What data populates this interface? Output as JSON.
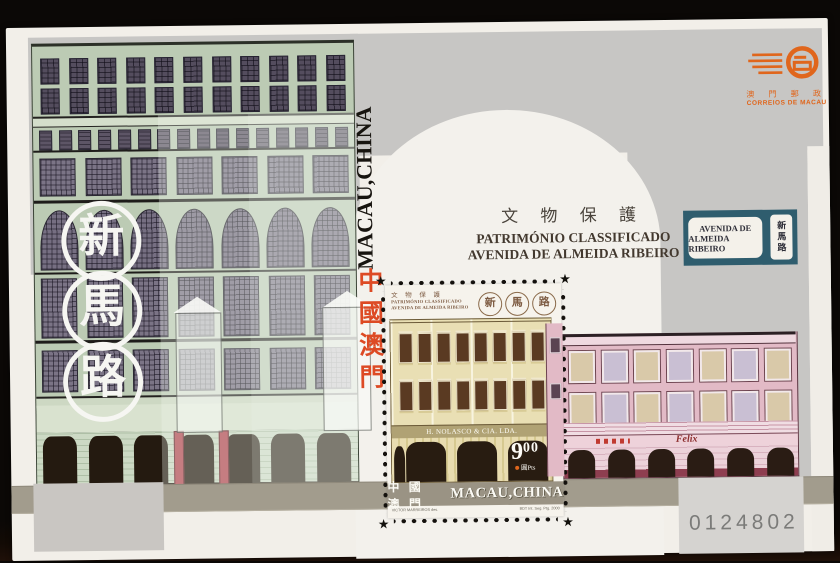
{
  "scan": {
    "serial_number": "0124802"
  },
  "sheet": {
    "street_name_chars": [
      "新",
      "馬",
      "路"
    ],
    "title_vertical_latin": "MACAU,CHINA",
    "title_vertical_cjk": "中國澳門",
    "heritage": {
      "cjk": "文 物 保 護",
      "portuguese_line1": "PATRIMÓNIO CLASSIFICADO",
      "portuguese_line2": "AVENIDA DE ALMEIDA RIBEIRO"
    },
    "plaque": {
      "line1": "AVENIDA DE",
      "line2": "ALMEIDA RIBEIRO",
      "cjk_vertical": "新馬路"
    },
    "post_office": {
      "cjk": "澳 門 郵 政",
      "latin": "CORREIOS DE MACAU"
    },
    "pink_shop_sign": "Felix"
  },
  "stamp": {
    "header_cjk": "文 物 保 護",
    "header_line1": "PATRIMÓNIO CLASSIFICADO",
    "header_line2": "AVENIDA DE ALMEIDA RIBEIRO",
    "seal_chars": [
      "新",
      "馬",
      "路"
    ],
    "shop_sign": "H. NOLASCO & CIA. LDA.",
    "value_integer": "9",
    "value_cents": "00",
    "value_unit": "圓Pts",
    "band_cjk": "中 國 澳 門",
    "band_latin": "MACAU,CHINA",
    "imprint_left": "VICTOR MARREIROS des.",
    "imprint_right": "BDT Int. Seg. Ptg. 2000"
  },
  "colors": {
    "logo_orange": "#e0661c",
    "plaque_teal": "#2f5d6e",
    "red_cjk": "#dd4a24",
    "band_olive": "#a29c8d",
    "sheet_gray": "#c7c6c4"
  }
}
